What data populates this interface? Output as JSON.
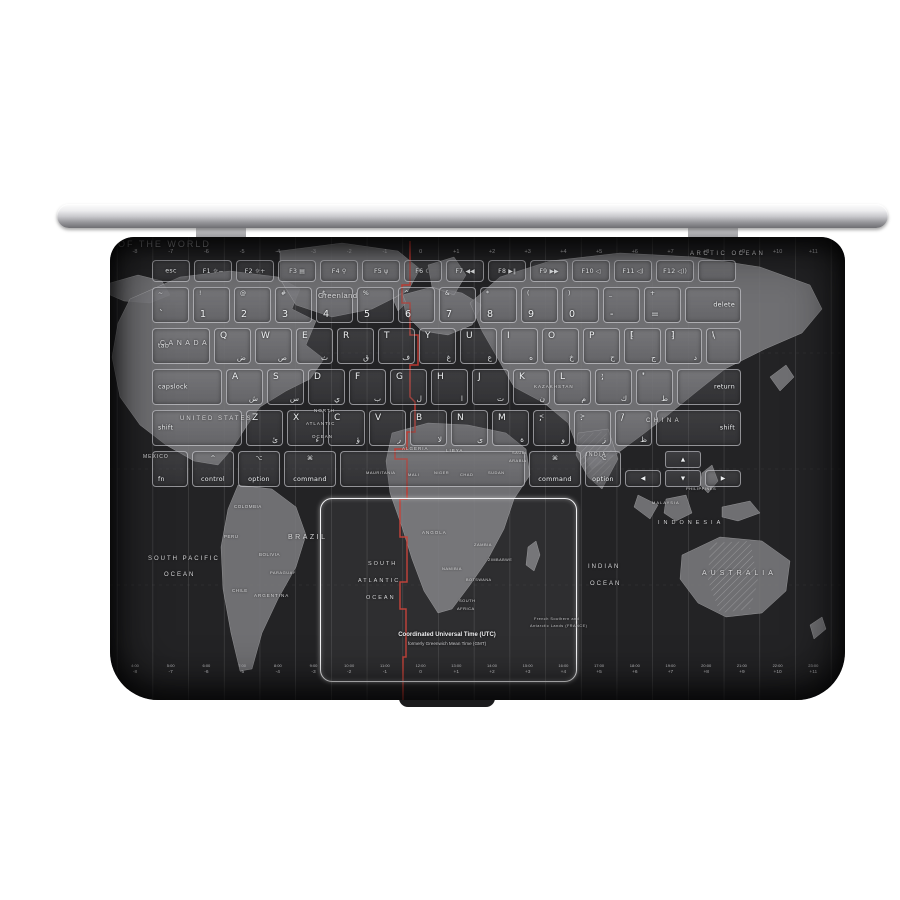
{
  "colors": {
    "page_bg": "#ffffff",
    "deck_bg": "#232325",
    "land": "#7a7a7d",
    "meridian_red": "#c23a30",
    "key_text": "#eef0f2",
    "trackpad_border": "#f2f2f4",
    "label_text": "#d8d8da"
  },
  "map": {
    "utc_caption": {
      "line1": "Coordinated Universal Time (UTC)",
      "line2": "formerly Greenwich Mean Time (GMT)"
    },
    "timezones": [
      {
        "offset": "-8",
        "time": "4:00"
      },
      {
        "offset": "-7",
        "time": "5:00"
      },
      {
        "offset": "-6",
        "time": "6:00"
      },
      {
        "offset": "-5",
        "time": "7:00"
      },
      {
        "offset": "-4",
        "time": "8:00"
      },
      {
        "offset": "-3",
        "time": "9:00"
      },
      {
        "offset": "-2",
        "time": "10:00"
      },
      {
        "offset": "-1",
        "time": "11:00"
      },
      {
        "offset": "0",
        "time": "12:00"
      },
      {
        "offset": "+1",
        "time": "13:00"
      },
      {
        "offset": "+2",
        "time": "14:00"
      },
      {
        "offset": "+3",
        "time": "15:00"
      },
      {
        "offset": "+4",
        "time": "16:00"
      },
      {
        "offset": "+5",
        "time": "17:00"
      },
      {
        "offset": "+6",
        "time": "18:00"
      },
      {
        "offset": "+7",
        "time": "19:00"
      },
      {
        "offset": "+8",
        "time": "20:00"
      },
      {
        "offset": "+9",
        "time": "21:00"
      },
      {
        "offset": "+10",
        "time": "22:00"
      },
      {
        "offset": "+11",
        "time": "23:00"
      }
    ],
    "labels": [
      {
        "text": "OF THE WORLD",
        "x": 8,
        "y": 2,
        "s": 9,
        "ls": 2,
        "c": "#96969a"
      },
      {
        "text": "ARCTIC OCEAN",
        "x": 580,
        "y": 14,
        "s": 6,
        "ls": 2.5
      },
      {
        "text": "Greenland",
        "x": 208,
        "y": 54,
        "s": 7.5,
        "c": "#dcdcde"
      },
      {
        "text": "CANADA",
        "x": 50,
        "y": 103,
        "s": 7,
        "ls": 3.5
      },
      {
        "text": "UNITED STATES",
        "x": 70,
        "y": 179,
        "s": 6,
        "ls": 2
      },
      {
        "text": "MEXICO",
        "x": 33,
        "y": 217,
        "s": 5,
        "ls": 1
      },
      {
        "text": "COLOMBIA",
        "x": 124,
        "y": 267,
        "s": 4.5
      },
      {
        "text": "PERU",
        "x": 114,
        "y": 297,
        "s": 4.5
      },
      {
        "text": "BRAZIL",
        "x": 178,
        "y": 297,
        "s": 7,
        "ls": 2.5
      },
      {
        "text": "BOLIVIA",
        "x": 149,
        "y": 315,
        "s": 4.5
      },
      {
        "text": "PARAGUAY",
        "x": 160,
        "y": 333,
        "s": 4
      },
      {
        "text": "CHILE",
        "x": 122,
        "y": 351,
        "s": 4.5
      },
      {
        "text": "ARGENTINA",
        "x": 144,
        "y": 356,
        "s": 4.5,
        "ls": 1
      },
      {
        "text": "SOUTH PACIFIC",
        "x": 38,
        "y": 319,
        "s": 6,
        "ls": 2
      },
      {
        "text": "OCEAN",
        "x": 54,
        "y": 335,
        "s": 6,
        "ls": 2
      },
      {
        "text": "NORTH",
        "x": 204,
        "y": 171,
        "s": 4.5,
        "ls": 1
      },
      {
        "text": "ATLANTIC",
        "x": 196,
        "y": 184,
        "s": 4.5,
        "ls": 1
      },
      {
        "text": "OCEAN",
        "x": 202,
        "y": 197,
        "s": 4.5,
        "ls": 1
      },
      {
        "text": "SOUTH",
        "x": 258,
        "y": 324,
        "s": 5.5,
        "ls": 2
      },
      {
        "text": "ATLANTIC",
        "x": 248,
        "y": 341,
        "s": 5.5,
        "ls": 2
      },
      {
        "text": "OCEAN",
        "x": 256,
        "y": 358,
        "s": 5.5,
        "ls": 2
      },
      {
        "text": "MAURITANIA",
        "x": 256,
        "y": 233,
        "s": 4
      },
      {
        "text": "MALI",
        "x": 298,
        "y": 235,
        "s": 4
      },
      {
        "text": "NIGER",
        "x": 324,
        "y": 233,
        "s": 4
      },
      {
        "text": "CHAD",
        "x": 350,
        "y": 235,
        "s": 4
      },
      {
        "text": "SUDAN",
        "x": 378,
        "y": 233,
        "s": 4
      },
      {
        "text": "ALGERIA",
        "x": 292,
        "y": 209,
        "s": 4.5,
        "ls": 1
      },
      {
        "text": "LIBYA",
        "x": 336,
        "y": 211,
        "s": 4.5,
        "ls": 1
      },
      {
        "text": "ANGOLA",
        "x": 312,
        "y": 293,
        "s": 4.5,
        "ls": 1
      },
      {
        "text": "ZAMBIA",
        "x": 364,
        "y": 305,
        "s": 4
      },
      {
        "text": "ZIMBABWE",
        "x": 378,
        "y": 321,
        "s": 3.8
      },
      {
        "text": "NAMIBIA",
        "x": 332,
        "y": 329,
        "s": 4
      },
      {
        "text": "BOTSWANA",
        "x": 356,
        "y": 341,
        "s": 3.8
      },
      {
        "text": "SOUTH",
        "x": 349,
        "y": 361,
        "s": 4
      },
      {
        "text": "AFRICA",
        "x": 347,
        "y": 369,
        "s": 4
      },
      {
        "text": "KAZAKHSTAN",
        "x": 424,
        "y": 147,
        "s": 4.5,
        "ls": 1
      },
      {
        "text": "CHINA",
        "x": 536,
        "y": 181,
        "s": 6,
        "ls": 3.5
      },
      {
        "text": "INDIA",
        "x": 476,
        "y": 215,
        "s": 5,
        "ls": 1.5
      },
      {
        "text": "SAUDI",
        "x": 402,
        "y": 213,
        "s": 4
      },
      {
        "text": "ARABIA",
        "x": 399,
        "y": 221,
        "s": 4
      },
      {
        "text": "PHILIPPINES",
        "x": 576,
        "y": 249,
        "s": 4
      },
      {
        "text": "MALAYSIA",
        "x": 542,
        "y": 263,
        "s": 4,
        "ls": 1
      },
      {
        "text": "INDONESIA",
        "x": 548,
        "y": 283,
        "s": 5.5,
        "ls": 4
      },
      {
        "text": "AUSTRALIA",
        "x": 592,
        "y": 333,
        "s": 7,
        "ls": 4
      },
      {
        "text": "INDIAN",
        "x": 478,
        "y": 327,
        "s": 6,
        "ls": 2
      },
      {
        "text": "OCEAN",
        "x": 480,
        "y": 344,
        "s": 6,
        "ls": 2
      },
      {
        "text": "French Southern and",
        "x": 424,
        "y": 380,
        "s": 3.8,
        "c": "#c4c4c6"
      },
      {
        "text": "Antarctic Lands (FRANCE)",
        "x": 420,
        "y": 387,
        "s": 3.8,
        "c": "#c4c4c6"
      }
    ]
  },
  "keyboard": {
    "rows": [
      {
        "keys": [
          {
            "name": "esc",
            "label": "esc",
            "w": 38,
            "t": "mod",
            "va": "mid"
          },
          {
            "name": "f1",
            "label": "F1",
            "icon": "☼−",
            "w": 38,
            "t": "fn"
          },
          {
            "name": "f2",
            "label": "F2",
            "icon": "☼+",
            "w": 38,
            "t": "fn"
          },
          {
            "name": "f3",
            "label": "F3",
            "icon": "▤",
            "w": 38,
            "t": "fn"
          },
          {
            "name": "f4",
            "label": "F4",
            "icon": "⚲",
            "w": 38,
            "t": "fn"
          },
          {
            "name": "f5",
            "label": "F5",
            "icon": "ψ",
            "w": 38,
            "t": "fn"
          },
          {
            "name": "f6",
            "label": "F6",
            "icon": "☾",
            "w": 38,
            "t": "fn"
          },
          {
            "name": "f7",
            "label": "F7",
            "icon": "◀◀",
            "w": 38,
            "t": "fn"
          },
          {
            "name": "f8",
            "label": "F8",
            "icon": "▶∥",
            "w": 38,
            "t": "fn"
          },
          {
            "name": "f9",
            "label": "F9",
            "icon": "▶▶",
            "w": 38,
            "t": "fn"
          },
          {
            "name": "f10",
            "label": "F10",
            "icon": "◁",
            "w": 38,
            "t": "fn"
          },
          {
            "name": "f11",
            "label": "F11",
            "icon": "◁)",
            "w": 38,
            "t": "fn"
          },
          {
            "name": "f12",
            "label": "F12",
            "icon": "◁))",
            "w": 38,
            "t": "fn"
          },
          {
            "name": "power",
            "label": "",
            "w": 38,
            "t": "fn"
          }
        ]
      },
      {
        "keys": [
          {
            "name": "backtick",
            "label": "`",
            "top": "~",
            "w": 37,
            "t": "num"
          },
          {
            "name": "1",
            "label": "1",
            "top": "!",
            "w": 37,
            "t": "num"
          },
          {
            "name": "2",
            "label": "2",
            "top": "@",
            "w": 37,
            "t": "num"
          },
          {
            "name": "3",
            "label": "3",
            "top": "#",
            "w": 37,
            "t": "num"
          },
          {
            "name": "4",
            "label": "4",
            "top": "$",
            "w": 37,
            "t": "num"
          },
          {
            "name": "5",
            "label": "5",
            "top": "%",
            "w": 37,
            "t": "num"
          },
          {
            "name": "6",
            "label": "6",
            "top": "^",
            "w": 37,
            "t": "num"
          },
          {
            "name": "7",
            "label": "7",
            "top": "&",
            "w": 37,
            "t": "num"
          },
          {
            "name": "8",
            "label": "8",
            "top": "*",
            "w": 37,
            "t": "num"
          },
          {
            "name": "9",
            "label": "9",
            "top": "(",
            "w": 37,
            "t": "num"
          },
          {
            "name": "0",
            "label": "0",
            "top": ")",
            "w": 37,
            "t": "num"
          },
          {
            "name": "minus",
            "label": "-",
            "top": "_",
            "w": 37,
            "t": "num"
          },
          {
            "name": "equals",
            "label": "=",
            "top": "+",
            "w": 37,
            "t": "num"
          },
          {
            "name": "delete",
            "label": "delete",
            "w": 56,
            "t": "mod",
            "align": "right",
            "va": "mid"
          }
        ]
      },
      {
        "keys": [
          {
            "name": "tab",
            "label": "tab",
            "w": 58,
            "t": "mod",
            "align": "left",
            "va": "mid"
          },
          {
            "name": "q",
            "label": "Q",
            "sub": "ض",
            "w": 37,
            "t": "letter"
          },
          {
            "name": "w",
            "label": "W",
            "sub": "ص",
            "w": 37,
            "t": "letter"
          },
          {
            "name": "e",
            "label": "E",
            "sub": "ث",
            "w": 37,
            "t": "letter"
          },
          {
            "name": "r",
            "label": "R",
            "sub": "ق",
            "w": 37,
            "t": "letter"
          },
          {
            "name": "t",
            "label": "T",
            "sub": "ف",
            "w": 37,
            "t": "letter"
          },
          {
            "name": "y",
            "label": "Y",
            "sub": "غ",
            "w": 37,
            "t": "letter"
          },
          {
            "name": "u",
            "label": "U",
            "sub": "ع",
            "w": 37,
            "t": "letter"
          },
          {
            "name": "i",
            "label": "I",
            "sub": "ه",
            "w": 37,
            "t": "letter"
          },
          {
            "name": "o",
            "label": "O",
            "sub": "خ",
            "w": 37,
            "t": "letter"
          },
          {
            "name": "p",
            "label": "P",
            "sub": "ح",
            "w": 37,
            "t": "letter"
          },
          {
            "name": "bracket-open",
            "label": "[",
            "top": "{",
            "sub": "ج",
            "w": 37,
            "t": "letter"
          },
          {
            "name": "bracket-close",
            "label": "]",
            "top": "}",
            "sub": "د",
            "w": 37,
            "t": "letter"
          },
          {
            "name": "backslash",
            "label": "\\",
            "top": "|",
            "w": 35,
            "t": "letter"
          }
        ]
      },
      {
        "keys": [
          {
            "name": "capslock",
            "label": "capslock",
            "w": 70,
            "t": "mod",
            "align": "left",
            "va": "mid"
          },
          {
            "name": "a",
            "label": "A",
            "sub": "ش",
            "w": 37,
            "t": "letter"
          },
          {
            "name": "s",
            "label": "S",
            "sub": "س",
            "w": 37,
            "t": "letter"
          },
          {
            "name": "d",
            "label": "D",
            "sub": "ي",
            "w": 37,
            "t": "letter"
          },
          {
            "name": "f",
            "label": "F",
            "sub": "ب",
            "w": 37,
            "t": "letter"
          },
          {
            "name": "g",
            "label": "G",
            "sub": "ل",
            "w": 37,
            "t": "letter"
          },
          {
            "name": "h",
            "label": "H",
            "sub": "ا",
            "w": 37,
            "t": "letter"
          },
          {
            "name": "j",
            "label": "J",
            "sub": "ت",
            "w": 37,
            "t": "letter"
          },
          {
            "name": "k",
            "label": "K",
            "sub": "ن",
            "w": 37,
            "t": "letter"
          },
          {
            "name": "l",
            "label": "L",
            "sub": "م",
            "w": 37,
            "t": "letter"
          },
          {
            "name": "semicolon",
            "label": ";",
            "top": ":",
            "sub": "ك",
            "w": 37,
            "t": "letter"
          },
          {
            "name": "quote",
            "label": "'",
            "top": "\"",
            "sub": "ط",
            "w": 37,
            "t": "letter"
          },
          {
            "name": "return",
            "label": "return",
            "w": 64,
            "t": "mod",
            "align": "right",
            "va": "mid"
          }
        ]
      },
      {
        "keys": [
          {
            "name": "shift-left",
            "label": "shift",
            "w": 90,
            "t": "mod",
            "align": "left",
            "va": "mid"
          },
          {
            "name": "z",
            "label": "Z",
            "sub": "ئ",
            "w": 37,
            "t": "letter"
          },
          {
            "name": "x",
            "label": "X",
            "sub": "ء",
            "w": 37,
            "t": "letter"
          },
          {
            "name": "c",
            "label": "C",
            "sub": "ؤ",
            "w": 37,
            "t": "letter"
          },
          {
            "name": "v",
            "label": "V",
            "sub": "ر",
            "w": 37,
            "t": "letter"
          },
          {
            "name": "b",
            "label": "B",
            "sub": "لا",
            "w": 37,
            "t": "letter"
          },
          {
            "name": "n",
            "label": "N",
            "sub": "ى",
            "w": 37,
            "t": "letter"
          },
          {
            "name": "m",
            "label": "M",
            "sub": "ة",
            "w": 37,
            "t": "letter"
          },
          {
            "name": "comma",
            "label": ",",
            "top": "<",
            "sub": "و",
            "w": 37,
            "t": "letter"
          },
          {
            "name": "period",
            "label": ".",
            "top": ">",
            "sub": "ز",
            "w": 37,
            "t": "letter"
          },
          {
            "name": "slash",
            "label": "/",
            "top": "?",
            "sub": "ظ",
            "w": 37,
            "t": "letter"
          },
          {
            "name": "shift-right",
            "label": "shift",
            "w": 85,
            "t": "mod",
            "align": "right",
            "va": "mid"
          }
        ]
      },
      {
        "keys": [
          {
            "name": "fn",
            "label": "fn",
            "w": 36,
            "t": "mod",
            "align": "left"
          },
          {
            "name": "control",
            "label": "control",
            "top": "^",
            "w": 42,
            "t": "mod2"
          },
          {
            "name": "option-left",
            "label": "option",
            "top": "⌥",
            "w": 42,
            "t": "mod2"
          },
          {
            "name": "command-left",
            "label": "command",
            "top": "⌘",
            "w": 52,
            "t": "mod2"
          },
          {
            "name": "space",
            "label": "",
            "w": 185,
            "t": "space"
          },
          {
            "name": "command-right",
            "label": "command",
            "top": "⌘",
            "w": 52,
            "t": "mod2"
          },
          {
            "name": "option-right",
            "label": "option",
            "top": "⌥",
            "w": 36,
            "t": "mod2"
          },
          {
            "name": "arrow-left",
            "label": "◀",
            "w": 36,
            "t": "arrow"
          },
          {
            "name": "arrow-updown",
            "up": "▲",
            "down": "▼",
            "w": 36,
            "t": "updown"
          },
          {
            "name": "arrow-right",
            "label": "▶",
            "w": 36,
            "t": "arrow"
          }
        ]
      }
    ]
  }
}
